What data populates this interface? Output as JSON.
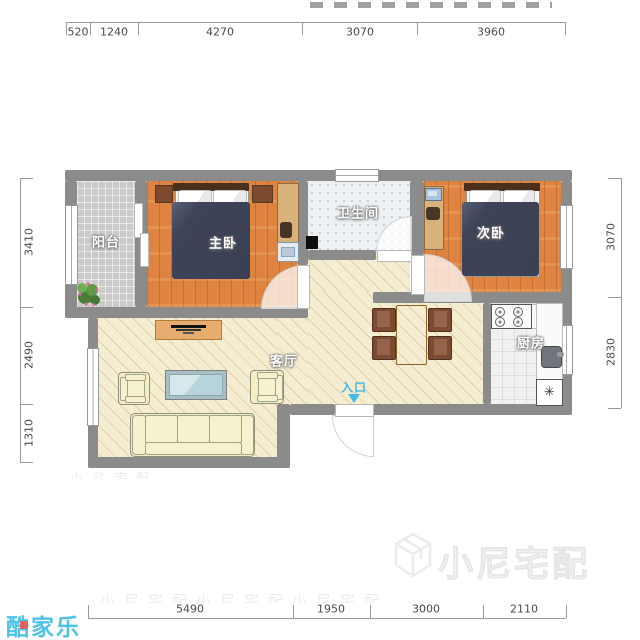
{
  "plan": {
    "rooms": {
      "balcony": "阳台",
      "master_bedroom": "主卧",
      "bathroom": "卫生间",
      "second_bedroom": "次卧",
      "living_room": "客厅",
      "kitchen": "厨房"
    },
    "entrance_label": "入口",
    "fridge_symbol": "✳"
  },
  "dimensions": {
    "top": [
      "520",
      "1240",
      "4270",
      "3070",
      "3960"
    ],
    "bottom": [
      "5490",
      "1950",
      "3000",
      "2110"
    ],
    "left": [
      "3410",
      "2490",
      "1310"
    ],
    "right": [
      "3070",
      "2830"
    ]
  },
  "watermarks": {
    "brand": "酷家乐",
    "overlay": "小尼宅配",
    "faint_row_1": "小尼宅配小尼宅配小尼宅配",
    "faint_row_2": "小尼宅配"
  },
  "colors": {
    "wall": "#8b8b8b",
    "wood_floor": "#de8340",
    "cream_floor": "#f5edd2",
    "blanket_navy": "#3d4257",
    "accent_blue": "#45b8e6",
    "brand_blue": "#4ec3e8"
  }
}
